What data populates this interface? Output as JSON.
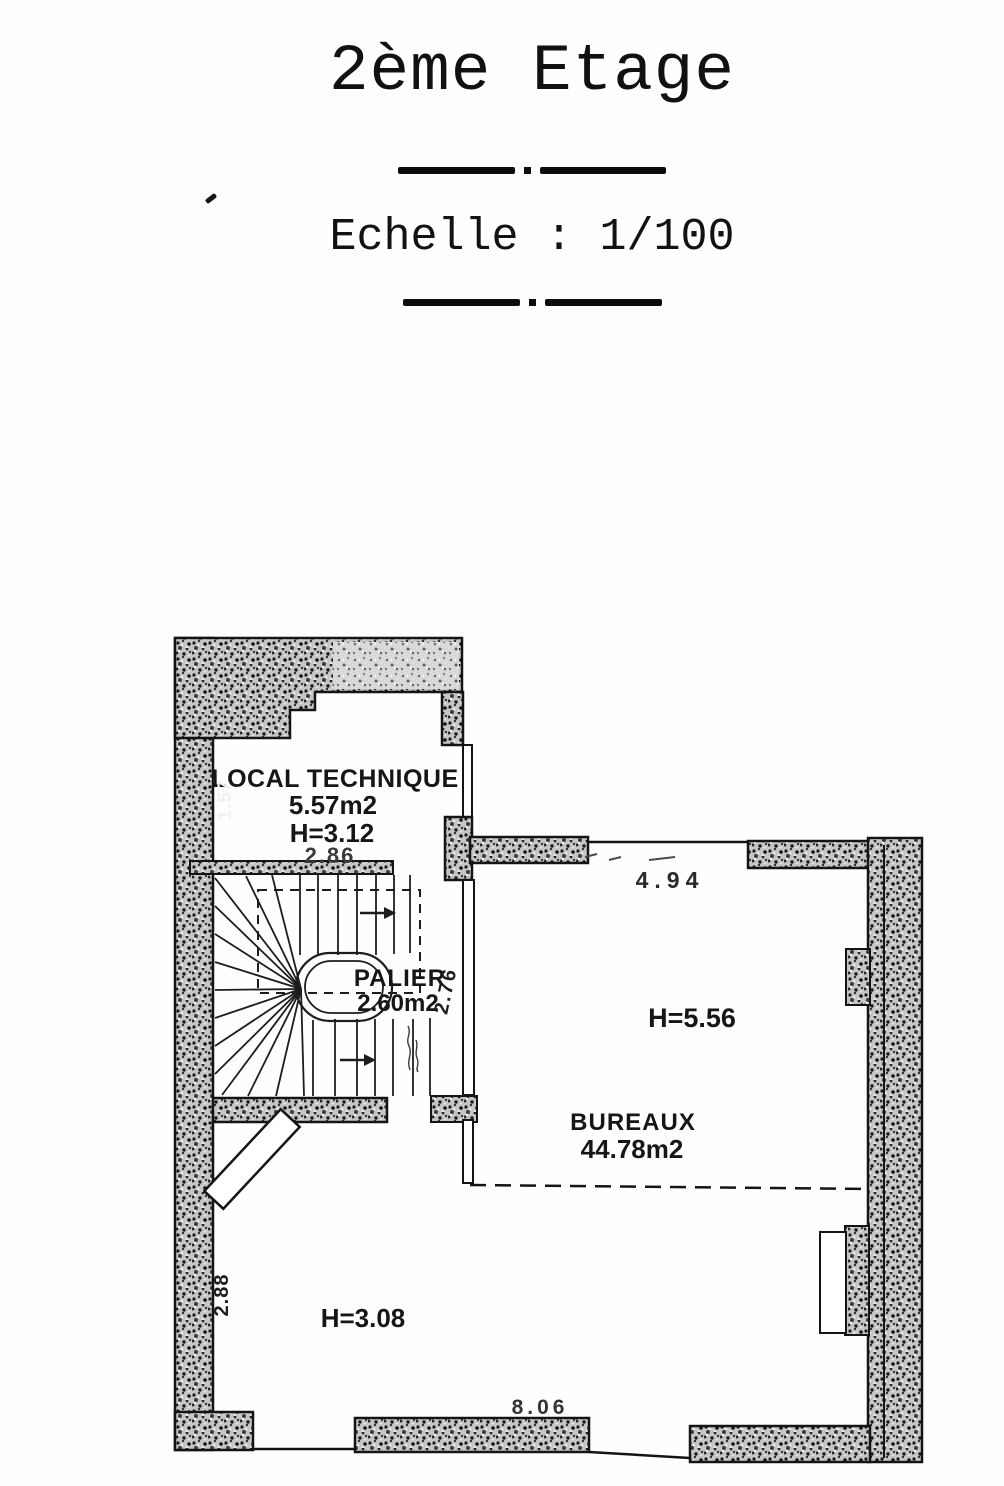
{
  "header": {
    "title": "2ème Etage",
    "scale_label": "Echelle : 1/100"
  },
  "rooms": {
    "local_technique": {
      "name": "LOCAL TECHNIQUE",
      "area": "5.57m2",
      "ceiling_height": "H=3.12",
      "width_dim": "2.86"
    },
    "palier": {
      "name": "PALIER",
      "area": "2.60m2"
    },
    "bureaux": {
      "name": "BUREAUX",
      "area": "44.78m2",
      "ceiling_height": "H=5.56"
    },
    "lower_space": {
      "ceiling_height": "H=3.08"
    }
  },
  "dimensions": {
    "local_technique_depth": "1.57",
    "palier_depth": "2.76",
    "bureaux_top_opening": "4.94",
    "lower_space_depth": "2.88",
    "bottom_wall_width": "8.06"
  }
}
